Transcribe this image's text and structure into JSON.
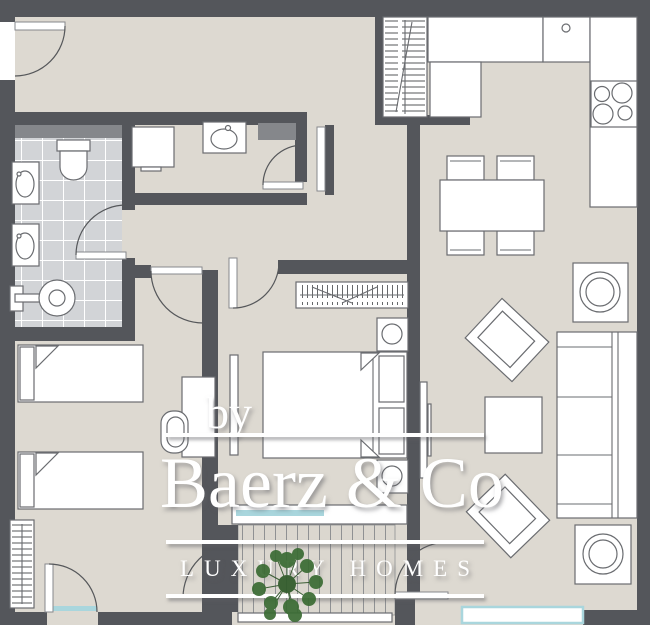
{
  "watermark": {
    "prefix": "by",
    "brand": "Baerz & Co",
    "tagline": "LUXURY HOMES",
    "text_color": "#ffffff"
  },
  "palette": {
    "wall": "#54565b",
    "floor": "#ddd9d1",
    "bathroom_tile": "#d2d4d7",
    "grout": "#ffffff",
    "fixture_fill": "#ffffff",
    "fixture_outline": "#6a6c70",
    "accent_gray": "#85878b",
    "glass": "#a9d6dd",
    "deck_line": "#8f9193",
    "tree_green": "#3a6b33"
  },
  "plan": {
    "type": "apartment-floor-plan",
    "rooms": [
      {
        "name": "entry-hall",
        "fixtures": [
          "entry-door"
        ]
      },
      {
        "name": "bathroom",
        "fixtures": [
          "toilet",
          "washbasin",
          "washbasin",
          "shower",
          "tiled-floor",
          "shelf"
        ]
      },
      {
        "name": "laundry-wc",
        "fixtures": [
          "washing-machine",
          "washbasin",
          "shelf",
          "door"
        ]
      },
      {
        "name": "kitchen",
        "fixtures": [
          "entry-wardrobe",
          "counter",
          "sink",
          "cooktop-4-burners",
          "chimney"
        ]
      },
      {
        "name": "dining-area",
        "fixtures": [
          "dining-table",
          "chair",
          "chair",
          "chair",
          "chair"
        ]
      },
      {
        "name": "living-room",
        "fixtures": [
          "sofa",
          "armchair",
          "armchair",
          "coffee-table",
          "tv",
          "appliance",
          "appliance",
          "window"
        ]
      },
      {
        "name": "master-bedroom",
        "fixtures": [
          "double-bed",
          "wardrobe",
          "nightstand",
          "nightstand",
          "tv",
          "glass-door"
        ]
      },
      {
        "name": "kids-bedroom",
        "fixtures": [
          "single-bed",
          "single-bed",
          "desk",
          "chair",
          "wardrobe",
          "glass-door"
        ]
      },
      {
        "name": "terrace",
        "fixtures": [
          "deck-floor",
          "tree",
          "door",
          "door"
        ]
      }
    ]
  }
}
